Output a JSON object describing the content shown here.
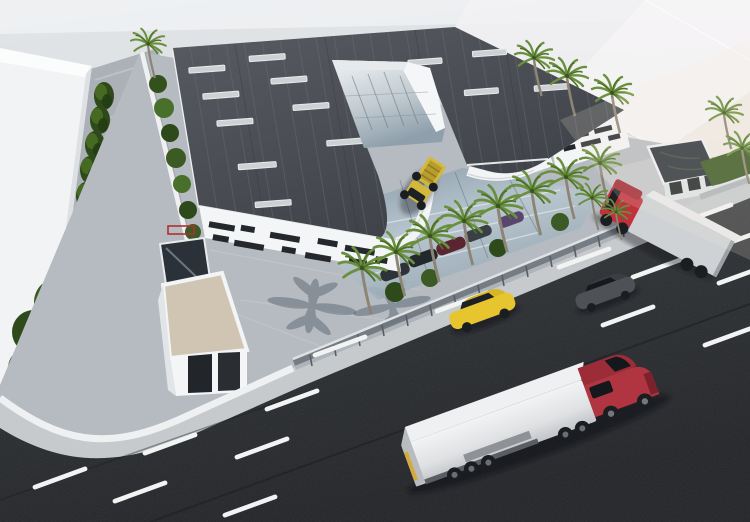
{
  "meta": {
    "title": "Aerial 3D architectural rendering of an industrial warehouse facility",
    "view": "birds-eye perspective",
    "has_text": false
  },
  "palette": {
    "background_top": "#e8ebee",
    "background_bottom": "#c6cacf",
    "ghost_building": "#f4f2f3",
    "neighbor_building": "#f1f3f4",
    "roof_dark": "#494d53",
    "roof_seam": "#6b6f75",
    "skylight": "#cdd1d4",
    "facade_white": "#f3f5f6",
    "window_slit": "#24282c",
    "plaza_paving": "#b6bbc1",
    "alley_paving": "#acb1b7",
    "asphalt": "#2a2d30",
    "lane_marking": "#f2f3f3",
    "sidewalk": "#c6cacd",
    "fence_wall": "#81888e",
    "glass_canopy": "#9db0bc",
    "atrium_glass": "#93a5b1",
    "tree_dark": "#2e4a1a",
    "tree_light": "#4d7226",
    "palm_frond": "#6a8f3f",
    "palm_trunk": "#8d8474",
    "shadow_blue": "#5a6673",
    "semi_cab_red": "#b03540",
    "semi_trailer_white": "#e6e8ea",
    "taxi_yellow": "#e7c52f",
    "sedan_gray": "#4e5257",
    "gate_truck_cab_red": "#c0313c",
    "gate_truck_trailer": "#ced2d5",
    "dump_truck_yellow": "#d3b93a",
    "gatehouse_roof_beige": "#cfc5b2",
    "gate_canopy_dark": "#2e343a",
    "entry_glass_dark": "#2b3138",
    "garden_green": "#3c5a24"
  },
  "scene": {
    "main_building": {
      "shape": "U-shaped warehouse with inner atrium courtyard",
      "roof": "dark standing-seam metal roof with light skylight strips",
      "skylight_count": 13,
      "facade": "white panels with irregular dark window slits and rounded banded corners"
    },
    "site": {
      "perimeter": "white low wall with mesh fence along the road",
      "gatehouse": "small white building with beige flat roof and two dark doorways",
      "gate_canopy": "white gate building with dark reflective flat roof",
      "glass_canopy": "reflective glazed carport with parked cars beneath",
      "plaza": "light paver courtyard with palm tree shadows"
    },
    "vehicles": [
      {
        "name": "semi-truck",
        "location": "road",
        "cab": "red",
        "trailer": "white",
        "heading": "north-east"
      },
      {
        "name": "taxi-sedan",
        "location": "road",
        "color": "yellow",
        "heading": "south-west"
      },
      {
        "name": "sedan",
        "location": "road",
        "color": "dark gray",
        "heading": "south-west"
      },
      {
        "name": "gate-truck",
        "location": "site entrance",
        "cab": "red",
        "trailer": "light gray",
        "heading": "entering site"
      },
      {
        "name": "dump-truck",
        "location": "inner courtyard",
        "color": "yellow"
      },
      {
        "name": "parked-cars-under-canopy",
        "count": 5
      }
    ],
    "vegetation": {
      "palm_trees": 16,
      "cypress_row": 8,
      "bushy_trees": 5,
      "hedges": "garden strips along walls"
    },
    "road": {
      "surface": "dark asphalt",
      "markings": "white dashed lane lines, diagonal orientation",
      "lanes_visible": 4
    },
    "background": "translucent white massing buildings (context volumes)"
  }
}
